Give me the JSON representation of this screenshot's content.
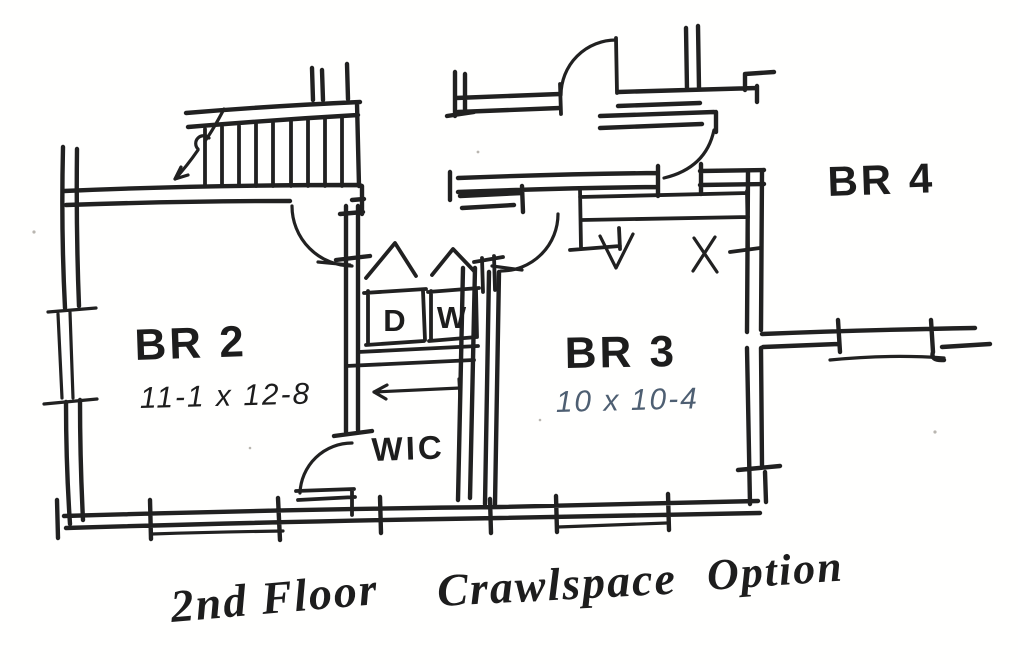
{
  "plan": {
    "rooms": {
      "br2": {
        "label": "BR 2",
        "dims": "11-1 x 12-8"
      },
      "br3": {
        "label": "BR 3",
        "dims": "10 x 10-4"
      },
      "br4": {
        "label": "BR 4"
      }
    },
    "laundry": {
      "dryer": "D",
      "washer": "W"
    },
    "wic": {
      "label": "WIC"
    },
    "caption": {
      "floor": "2nd Floor",
      "space": "Crawlspace",
      "option": "Option"
    },
    "colors": {
      "ink": "#212121",
      "dimension_blue": "#4e5f72",
      "paper": "#fffffe"
    }
  }
}
